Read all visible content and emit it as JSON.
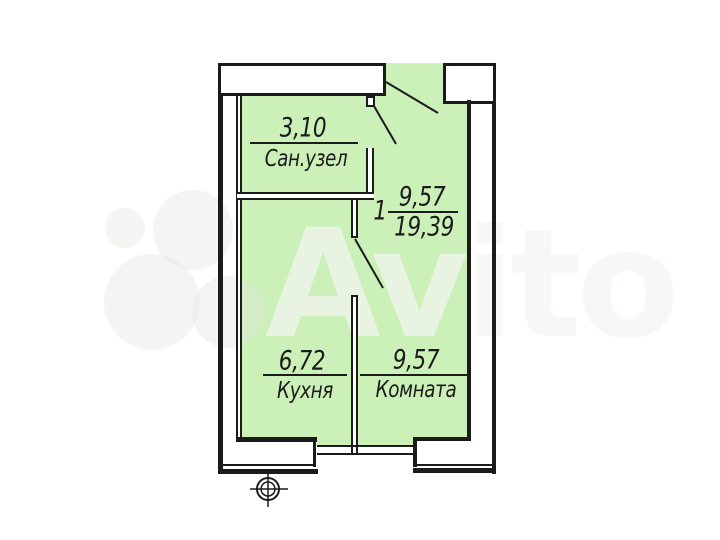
{
  "watermark": {
    "brand": "Avito"
  },
  "colors": {
    "room_fill": "#cbf0b8",
    "line": "#1b1b1b"
  },
  "floorplan": {
    "bathroom": {
      "area": "3,10",
      "label": "Сан.узел"
    },
    "unit": {
      "number": "1",
      "living_area": "9,57",
      "total_area": "19,39"
    },
    "kitchen": {
      "area": "6,72",
      "label": "Кухня"
    },
    "room": {
      "area": "9,57",
      "label": "Комната"
    }
  }
}
